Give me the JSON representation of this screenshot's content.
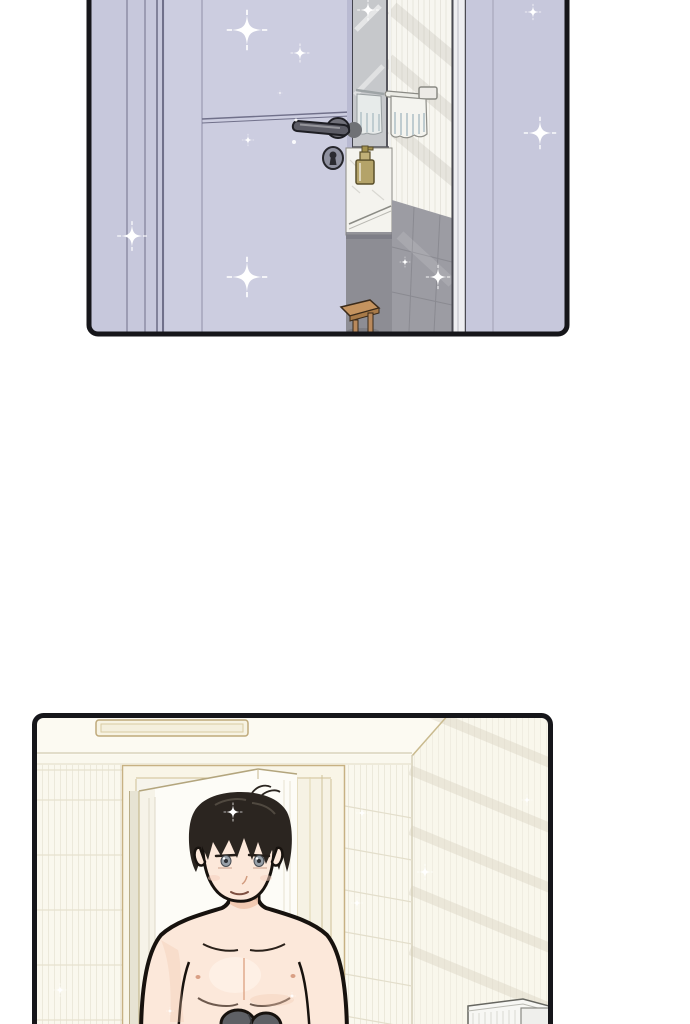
{
  "page": {
    "kind": "vertical webtoon comic strip",
    "background": "#ffffff",
    "text_content": "none"
  },
  "colors": {
    "ink": "#16161a",
    "paper": "#ffffff",
    "lavender": "#c7c8dc",
    "lavender-door": "#cccde0",
    "line-purple": "#70708a",
    "mirror-grey": "#c6c8cb",
    "tile-white": "#f7f6f0",
    "tile-stripe": "#e7e5dd",
    "tile-grey": "#9c9ca3",
    "tile-grey-dark": "#8d8d94",
    "marble": "#f4f3ee",
    "brass": "#b4a369",
    "towel-stripe": "#bfccd0",
    "wood": "#c4935f",
    "handle-grey": "#5c5c66",
    "cream-wall": "#faf8ee",
    "cream-ceiling": "#fcfaf2",
    "cream-stripe": "#ece9db",
    "tan-line": "#c7b183",
    "door-white": "#fdfcf7",
    "skin": "#fce8da",
    "skin-shadow": "#f0c4aa",
    "hair-black": "#2b2520",
    "eye-grey": "#98a0a8",
    "bundle-grey": "#5e6065",
    "radiator-white": "#f7f7f4"
  },
  "panels": [
    {
      "name": "bathroom-door-panel",
      "description": "Pale lavender bathroom door standing ajar; through the gap a mirror, a towel rail with a striped towel, a marble washbasin with a brass soap dispenser, a grey tiled lower wall and a small wooden stool; sparkles drift across the door. Panel is cropped at the top of the page.",
      "bounds": {
        "x": 89,
        "y": -18,
        "width": 478,
        "height": 352
      },
      "elements": [
        "lavender door ajar",
        "door handle",
        "keyhole",
        "door frame strips",
        "mirror",
        "towel rail with striped towel",
        "marble washbasin",
        "brass soap dispenser",
        "white tiled wall",
        "grey tiled lower wall",
        "wooden stool",
        "door jamb",
        "sparkles"
      ],
      "sparkles": [
        [
          247,
          30,
          1.5
        ],
        [
          300,
          53,
          0.7
        ],
        [
          280,
          93,
          0.2
        ],
        [
          248,
          140,
          0.45
        ],
        [
          132,
          236,
          1.1
        ],
        [
          247,
          277,
          1.5
        ],
        [
          540,
          133,
          1.2
        ],
        [
          533,
          12,
          0.6
        ],
        [
          368,
          10,
          0.8
        ],
        [
          438,
          277,
          0.9
        ],
        [
          405,
          262,
          0.4
        ]
      ]
    },
    {
      "name": "doorway-man-panel",
      "description": "A shirtless young man with tousled black hair and grey eyes stands in a bright cream doorway in front of an open white door, holding dark grey clothes; striped tile walls, a ceiling vent and a white radiator at the lower right. Panel is cropped at the bottom of the page.",
      "bounds": {
        "x": 34,
        "y": 715,
        "width": 516,
        "height": 326
      },
      "elements": [
        "ceiling vent",
        "cream tiled walls",
        "door frame",
        "open white door",
        "shirtless man with black hair",
        "grey eyes",
        "dark grey clothes bundle",
        "white radiator",
        "sparkles"
      ],
      "sparkles": [
        [
          233,
          812,
          0.7
        ],
        [
          362,
          813,
          0.45
        ],
        [
          425,
          872,
          0.6
        ],
        [
          357,
          903,
          0.45
        ],
        [
          527,
          800,
          0.4
        ],
        [
          60,
          990,
          0.5
        ],
        [
          292,
          996,
          0.3
        ],
        [
          170,
          1011,
          0.3
        ]
      ]
    }
  ]
}
